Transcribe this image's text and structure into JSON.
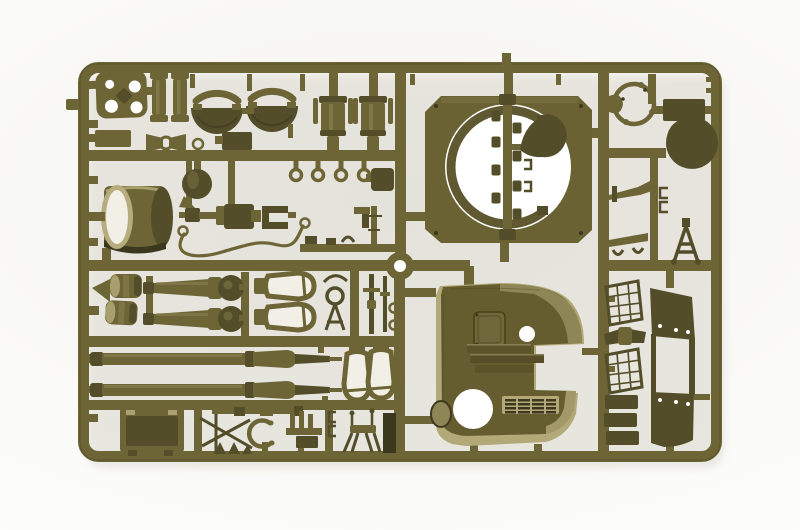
{
  "photo": {
    "subject": "injection-molded plastic model kit sprue with military vehicle parts",
    "plastic_color_name": "olive drab",
    "background": "white seamless backdrop",
    "frame": "landscape rectangular runner frame with internal runners"
  },
  "colors": {
    "bg": "#ffffff",
    "bg-tint": "#f4f3ee",
    "shadow": "#dbd9cf",
    "olive": "#6d6536",
    "olive-dark": "#534d29",
    "olive-deep": "#3c381e",
    "olive-light": "#8f8655",
    "olive-pale": "#b6ac7d",
    "face": "#f1efe6",
    "hole": "#ffffff",
    "hull": "#655d2f",
    "hull-pale": "#b3a878",
    "plate": "#6a6232",
    "ring": "#5f5830"
  },
  "parts": {
    "mount_plate": "four-hole mounting plate",
    "shock_absorbers": "shock absorber cylinders",
    "gun_shield_bowls": "rotor shield halves with arcs",
    "recoil_cylinders": "recoil cylinder housings",
    "pulpit_plate": "hull top plate with machine-gun pulpit ring",
    "ring_strip": "strip of small fittings",
    "seat_cover": "teardrop seat/cover",
    "ring_sight": "ring mount",
    "dome": "dome cover",
    "a_frame": "travel-lock A-frame",
    "drum": "open drum housing",
    "breech": "gun breech assembly",
    "tow_cable": "tow cable with end loops",
    "hook_rings": "lifting ring fittings",
    "road_wheels": "road wheel hubs",
    "howitzer_halves": "howitzer barrel halves with round collars",
    "shell_bottles": "bottle-shaped open parts",
    "machine_gun": "machine gun parts",
    "gun_barrels": "long gun barrels",
    "stowage_box": "stowage box panel",
    "cleaning_rod": "cleaning rod",
    "tow_ring": "open tow ring",
    "stand": "four-leg stand",
    "hull_roof": "fighting compartment roof plate with hatch, grille and openings",
    "mesh_baskets": "mesh stowage baskets",
    "ladder_frame": "open ladder frame plate",
    "small_plates": "small armor plates"
  }
}
